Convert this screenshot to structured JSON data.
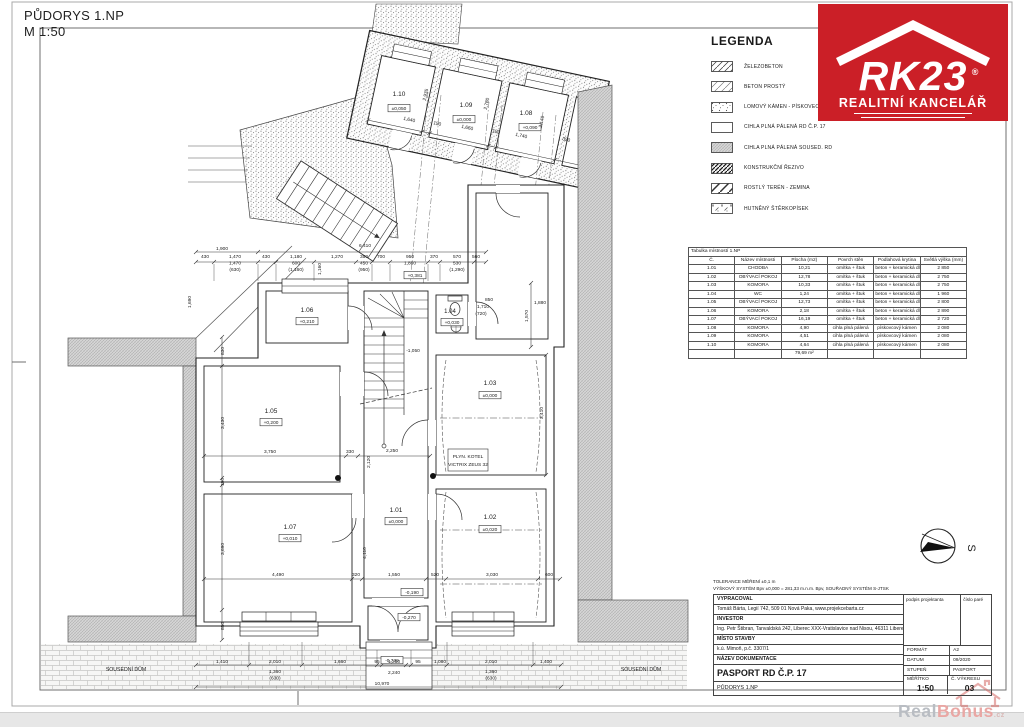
{
  "page": {
    "title_line1": "PŮDORYS 1.NP",
    "title_line2": "M 1:50"
  },
  "logo": {
    "brand": "RK23",
    "registered": "®",
    "subtitle": "REALITNÍ KANCELÁŘ",
    "color": "#cb1f27"
  },
  "legend": {
    "title": "LEGENDA",
    "items": [
      {
        "label": "ŽELEZOBETON",
        "pattern": "pat-zel"
      },
      {
        "label": "BETON PROSTÝ",
        "pattern": "pat-bet"
      },
      {
        "label": "LOMOVÝ KÁMEN - PÍSKOVEC",
        "pattern": "pat-kam"
      },
      {
        "label": "CIHLA PLNÁ PÁLENÁ RD Č.P. 17",
        "pattern": "white"
      },
      {
        "label": "CIHLA PLNÁ PÁLENÁ SOUSED. RD",
        "pattern": "pat-sou"
      },
      {
        "label": "KONSTRUKČNÍ ŘEZIVO",
        "pattern": "pat-rez"
      },
      {
        "label": "ROSTLÝ TERÉN - ZEMINA",
        "pattern": "pat-ter"
      },
      {
        "label": "HUTNĚNÝ ŠTĚRKOPÍSEK",
        "pattern": "pat-ste"
      }
    ]
  },
  "room_table": {
    "title": "Tabulka místností 1.NP",
    "columns": [
      "Č.",
      "Název místnosti",
      "Plocha (m2)",
      "Povrch stěn",
      "Podlahová krytina",
      "Světlá výška (mm)"
    ],
    "rows": [
      [
        "1.01",
        "CHODBA",
        "10,21",
        "omítka + štuk",
        "beton + keramická dlažba",
        "2 850"
      ],
      [
        "1.02",
        "OBÝVACÍ POKOJ",
        "12,78",
        "omítka + štuk",
        "beton + keramická dlažba",
        "2 750"
      ],
      [
        "1.03",
        "KOMORA",
        "10,33",
        "omítka + štuk",
        "beton + keramická dlažba",
        "2 750"
      ],
      [
        "1.04",
        "WC",
        "1,24",
        "omítka + štuk",
        "beton + keramická dlažba",
        "1 960"
      ],
      [
        "1.05",
        "OBÝVACÍ POKOJ",
        "12,73",
        "omítka + štuk",
        "beton + keramická dlažba",
        "2 800"
      ],
      [
        "1.06",
        "KOMORA",
        "2,18",
        "omítka + štuk",
        "beton + keramická dlažba",
        "2 890"
      ],
      [
        "1.07",
        "OBÝVACÍ POKOJ",
        "16,19",
        "omítka + štuk",
        "beton + keramická dlažba",
        "2 720"
      ],
      [
        "1.08",
        "KOMORA",
        "4,90",
        "cihla plná pálená",
        "pískovcový kámen",
        "2 080"
      ],
      [
        "1.09",
        "KOMORA",
        "4,51",
        "cihla plná pálená",
        "pískovcový kámen",
        "2 080"
      ],
      [
        "1.10",
        "KOMORA",
        "4,64",
        "cihla plná pálená",
        "pískovcový kámen",
        "2 080"
      ]
    ],
    "total": "79,69 m²"
  },
  "title_block": {
    "tolerance1": "TOLERANCE MĚŘENÍ ±0,1 m",
    "tolerance2": "VÝŠKOVÝ SYSTÉM Bpv ±0,000 = 281,33 m.n.m. Bpv, SOUŘADNÝ SYSTÉM S-JTSK",
    "vypracoval_label": "VYPRACOVAL",
    "vypracoval_value": "Tomáš Bárta, Legií 742, 509 01 Nová Paka, www.projekcebarta.cz",
    "investor_label": "INVESTOR",
    "investor_value": "Ing. Petr Štibran, Tanvaldská 242, Liberec XXX-Vratislavice nad Nisou, 46311 Liberec",
    "misto_label": "MÍSTO STAVBY",
    "misto_value": "k.ú. Mimoň, p.č. 3307/1",
    "nazev_label": "NÁZEV DOKUMENTACE",
    "nazev_value": "PASPORT RD Č.P. 17",
    "drawing_name": "PŮDORYS 1.NP",
    "podpis_label": "podpis projektanta",
    "cislo_pare_label": "číslo paré",
    "format_label": "FORMÁT",
    "format_value": "A2",
    "datum_label": "DATUM",
    "datum_value": "09/2020",
    "stupen_label": "STUPEŇ",
    "stupen_value": "PASPORT",
    "meritko_label": "MĚŘÍTKO",
    "meritko_value": "1:50",
    "vykres_label": "Č. VÝKRESU",
    "vykres_value": "03"
  },
  "compass": {
    "label": "S"
  },
  "watermark": {
    "part1": "Real",
    "part2": "Bonus",
    "suffix": ".cz"
  },
  "plan": {
    "annotations": [
      {
        "t": "1.10",
        "x": 399,
        "y": 96,
        "s": 6.5
      },
      {
        "t": "±0,050",
        "x": 399,
        "y": 110,
        "b": 1
      },
      {
        "t": "1.09",
        "x": 466,
        "y": 107,
        "s": 6.5
      },
      {
        "t": "±0,000",
        "x": 464,
        "y": 121,
        "b": 1
      },
      {
        "t": "1.08",
        "x": 526,
        "y": 115,
        "s": 6.5
      },
      {
        "t": "+0,090",
        "x": 530,
        "y": 129,
        "b": 1
      },
      {
        "t": "1,640",
        "x": 409,
        "y": 121,
        "r": 12
      },
      {
        "t": "150",
        "x": 437,
        "y": 125,
        "r": 12
      },
      {
        "t": "1,660",
        "x": 467,
        "y": 129,
        "r": 12
      },
      {
        "t": "150",
        "x": 496,
        "y": 133,
        "r": 12
      },
      {
        "t": "1,740",
        "x": 521,
        "y": 137,
        "r": 12
      },
      {
        "t": "350",
        "x": 566,
        "y": 141,
        "r": 12
      },
      {
        "t": "2,935",
        "x": 427,
        "y": 95,
        "r": -78
      },
      {
        "t": "2,780",
        "x": 488,
        "y": 104,
        "r": -78
      },
      {
        "t": "2,140",
        "x": 543,
        "y": 122,
        "r": -78
      },
      {
        "t": "1,900",
        "x": 222,
        "y": 250
      },
      {
        "t": "6,410",
        "x": 365,
        "y": 247
      },
      {
        "t": "430",
        "x": 205,
        "y": 258
      },
      {
        "t": "1,470",
        "x": 235,
        "y": 258
      },
      {
        "t": "430",
        "x": 266,
        "y": 258
      },
      {
        "t": "1,180",
        "x": 296,
        "y": 258
      },
      {
        "t": "1,270",
        "x": 337,
        "y": 258
      },
      {
        "t": "350",
        "x": 364,
        "y": 258
      },
      {
        "t": "700",
        "x": 381,
        "y": 258
      },
      {
        "t": "950",
        "x": 410,
        "y": 258
      },
      {
        "t": "370",
        "x": 434,
        "y": 258
      },
      {
        "t": "570",
        "x": 457,
        "y": 258
      },
      {
        "t": "560",
        "x": 476,
        "y": 258
      },
      {
        "t": "1,470",
        "x": 235,
        "y": 264.5
      },
      {
        "t": "(630)",
        "x": 235,
        "y": 271
      },
      {
        "t": "600",
        "x": 296,
        "y": 264.5
      },
      {
        "t": "(1,160)",
        "x": 296,
        "y": 271
      },
      {
        "t": "450",
        "x": 364,
        "y": 264.5
      },
      {
        "t": "(950)",
        "x": 364,
        "y": 271
      },
      {
        "t": "1,860",
        "x": 410,
        "y": 264.5
      },
      {
        "t": "530",
        "x": 457,
        "y": 264.5
      },
      {
        "t": "(1,290)",
        "x": 457,
        "y": 271
      },
      {
        "t": "1,160",
        "x": 321,
        "y": 269,
        "r": -90
      },
      {
        "t": "1.06",
        "x": 307,
        "y": 312,
        "s": 6.5
      },
      {
        "t": "+0,210",
        "x": 307,
        "y": 323,
        "b": 1
      },
      {
        "t": "1.05",
        "x": 271,
        "y": 413,
        "s": 6.5
      },
      {
        "t": "+0,200",
        "x": 271,
        "y": 424,
        "b": 1
      },
      {
        "t": "1.03",
        "x": 490,
        "y": 385,
        "s": 6.5
      },
      {
        "t": "±0,000",
        "x": 490,
        "y": 397,
        "b": 1
      },
      {
        "t": "1.04",
        "x": 450,
        "y": 313,
        "s": 6
      },
      {
        "t": "+0,030",
        "x": 452,
        "y": 324,
        "b": 1
      },
      {
        "t": "1.07",
        "x": 290,
        "y": 529,
        "s": 6.5
      },
      {
        "t": "+0,010",
        "x": 290,
        "y": 540,
        "b": 1
      },
      {
        "t": "1.01",
        "x": 396,
        "y": 512,
        "s": 6.5
      },
      {
        "t": "±0,000",
        "x": 396,
        "y": 523,
        "b": 1
      },
      {
        "t": "1.02",
        "x": 490,
        "y": 519,
        "s": 6.5
      },
      {
        "t": "±0,020",
        "x": 490,
        "y": 531,
        "b": 1
      },
      {
        "t": "+0,381",
        "x": 415,
        "y": 277,
        "b": 1
      },
      {
        "t": "-1,050",
        "x": 413,
        "y": 352
      },
      {
        "t": "-0,190",
        "x": 412,
        "y": 594,
        "b": 1
      },
      {
        "t": "-0,270",
        "x": 409,
        "y": 619,
        "b": 1
      },
      {
        "t": "-0,739",
        "x": 392,
        "y": 662,
        "b": 1
      },
      {
        "t": "PLYN. KOTEL",
        "x": 468,
        "y": 458
      },
      {
        "t": "VICTRIX ZEUS 32",
        "x": 468,
        "y": 466
      },
      {
        "t": "SOUSEDNÍ DŮM",
        "x": 126,
        "y": 671,
        "s": 5.2
      },
      {
        "t": "SOUSEDNÍ DŮM",
        "x": 641,
        "y": 671,
        "s": 5.2
      },
      {
        "t": "830",
        "x": 224,
        "y": 351,
        "r": -90
      },
      {
        "t": "3,430",
        "x": 224,
        "y": 423,
        "r": -90
      },
      {
        "t": "190",
        "x": 224,
        "y": 482,
        "r": -90
      },
      {
        "t": "3,690",
        "x": 224,
        "y": 549,
        "r": -90
      },
      {
        "t": "850",
        "x": 224,
        "y": 626,
        "r": -90
      },
      {
        "t": "1,690",
        "x": 191,
        "y": 302,
        "r": -90
      },
      {
        "t": "1,570",
        "x": 528,
        "y": 316,
        "r": -90
      },
      {
        "t": "3,410",
        "x": 543,
        "y": 413,
        "r": -90
      },
      {
        "t": "850",
        "x": 489,
        "y": 301
      },
      {
        "t": "1,710",
        "x": 483,
        "y": 308
      },
      {
        "t": "(720)",
        "x": 481,
        "y": 315
      },
      {
        "t": "1,880",
        "x": 540,
        "y": 304
      },
      {
        "t": "3,750",
        "x": 270,
        "y": 453
      },
      {
        "t": "330",
        "x": 350,
        "y": 453
      },
      {
        "t": "2,250",
        "x": 392,
        "y": 452
      },
      {
        "t": "2,120",
        "x": 370,
        "y": 462,
        "r": -90
      },
      {
        "t": "4,110",
        "x": 366,
        "y": 553,
        "r": -90
      },
      {
        "t": "4,490",
        "x": 278,
        "y": 576
      },
      {
        "t": "320",
        "x": 356,
        "y": 576
      },
      {
        "t": "1,550",
        "x": 394,
        "y": 576
      },
      {
        "t": "520",
        "x": 435,
        "y": 576
      },
      {
        "t": "3,030",
        "x": 492,
        "y": 576
      },
      {
        "t": "600",
        "x": 549,
        "y": 576
      },
      {
        "t": "1,410",
        "x": 222,
        "y": 663
      },
      {
        "t": "2,010",
        "x": 275,
        "y": 663
      },
      {
        "t": "1,360",
        "x": 275,
        "y": 673
      },
      {
        "t": "(630)",
        "x": 275,
        "y": 679.5
      },
      {
        "t": "1,660",
        "x": 340,
        "y": 663
      },
      {
        "t": "95",
        "x": 377,
        "y": 663
      },
      {
        "t": "1,210",
        "x": 394,
        "y": 663
      },
      {
        "t": "2,240",
        "x": 394,
        "y": 674
      },
      {
        "t": "95",
        "x": 418,
        "y": 663
      },
      {
        "t": "1,080",
        "x": 440,
        "y": 663
      },
      {
        "t": "2,010",
        "x": 491,
        "y": 663
      },
      {
        "t": "1,360",
        "x": 491,
        "y": 673
      },
      {
        "t": "(630)",
        "x": 491,
        "y": 679.5
      },
      {
        "t": "1,400",
        "x": 546,
        "y": 663
      },
      {
        "t": "10,970",
        "x": 382,
        "y": 685
      }
    ]
  }
}
